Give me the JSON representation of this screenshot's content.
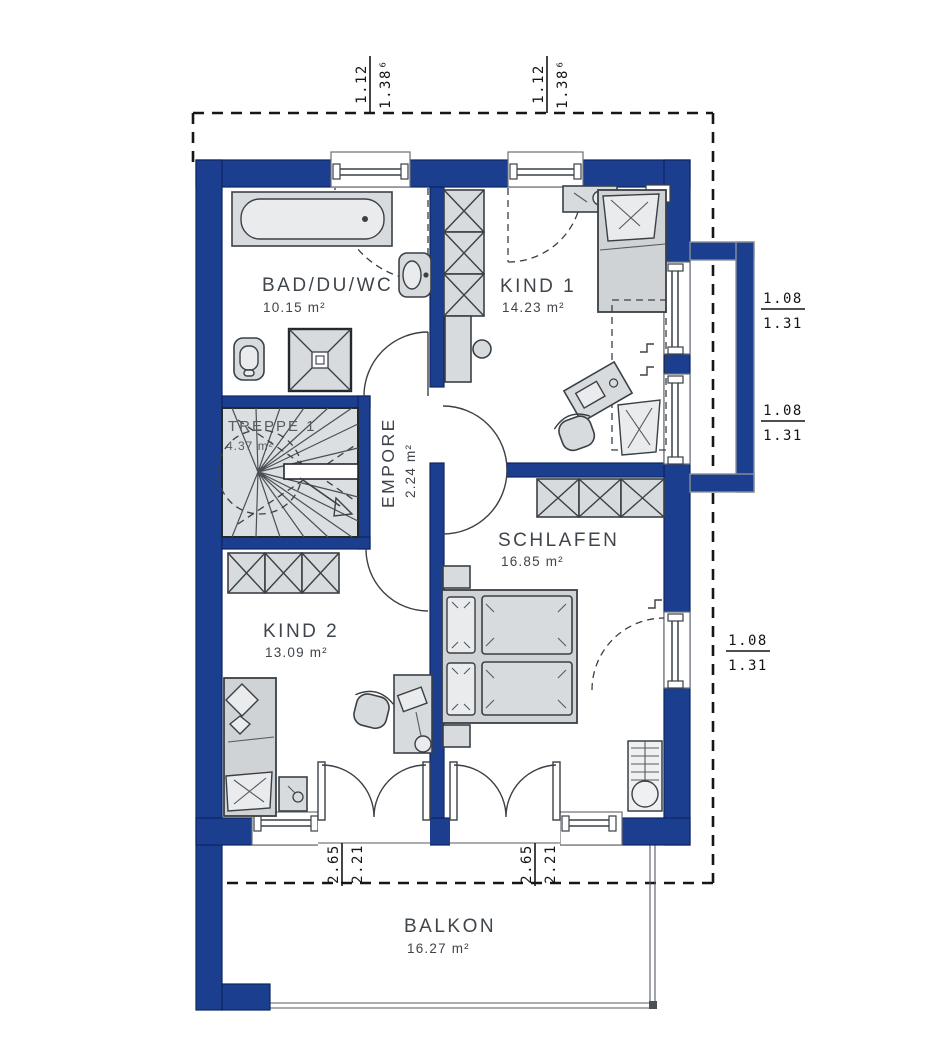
{
  "rooms": {
    "bad": {
      "name": "BAD/DU/WC",
      "area": "10.15 m²"
    },
    "kind1": {
      "name": "KIND 1",
      "area": "14.23 m²"
    },
    "treppe": {
      "name": "TREPPE 1",
      "area": "4.37 m²"
    },
    "empore": {
      "name": "EMPORE",
      "area": "2.24 m²"
    },
    "schlafen": {
      "name": "SCHLAFEN",
      "area": "16.85 m²"
    },
    "kind2": {
      "name": "KIND 2",
      "area": "13.09 m²"
    },
    "balkon": {
      "name": "BALKON",
      "area": "16.27 m²"
    }
  },
  "dimensions": {
    "top_left": {
      "a": "1.12",
      "b": "1.38⁶"
    },
    "top_right": {
      "a": "1.12",
      "b": "1.38⁶"
    },
    "right_upper": {
      "a": "1.08",
      "b": "1.31"
    },
    "right_middle": {
      "a": "1.08",
      "b": "1.31"
    },
    "right_lower": {
      "a": "1.08",
      "b": "1.31"
    },
    "bottom_left": {
      "a": "2.65",
      "b": "2.21"
    },
    "bottom_right": {
      "a": "2.65",
      "b": "2.21"
    }
  },
  "colors": {
    "wall": "#1b3e8f",
    "furniture": "#d8dbdd",
    "background": "#ffffff",
    "dashed_line": "#161616"
  }
}
